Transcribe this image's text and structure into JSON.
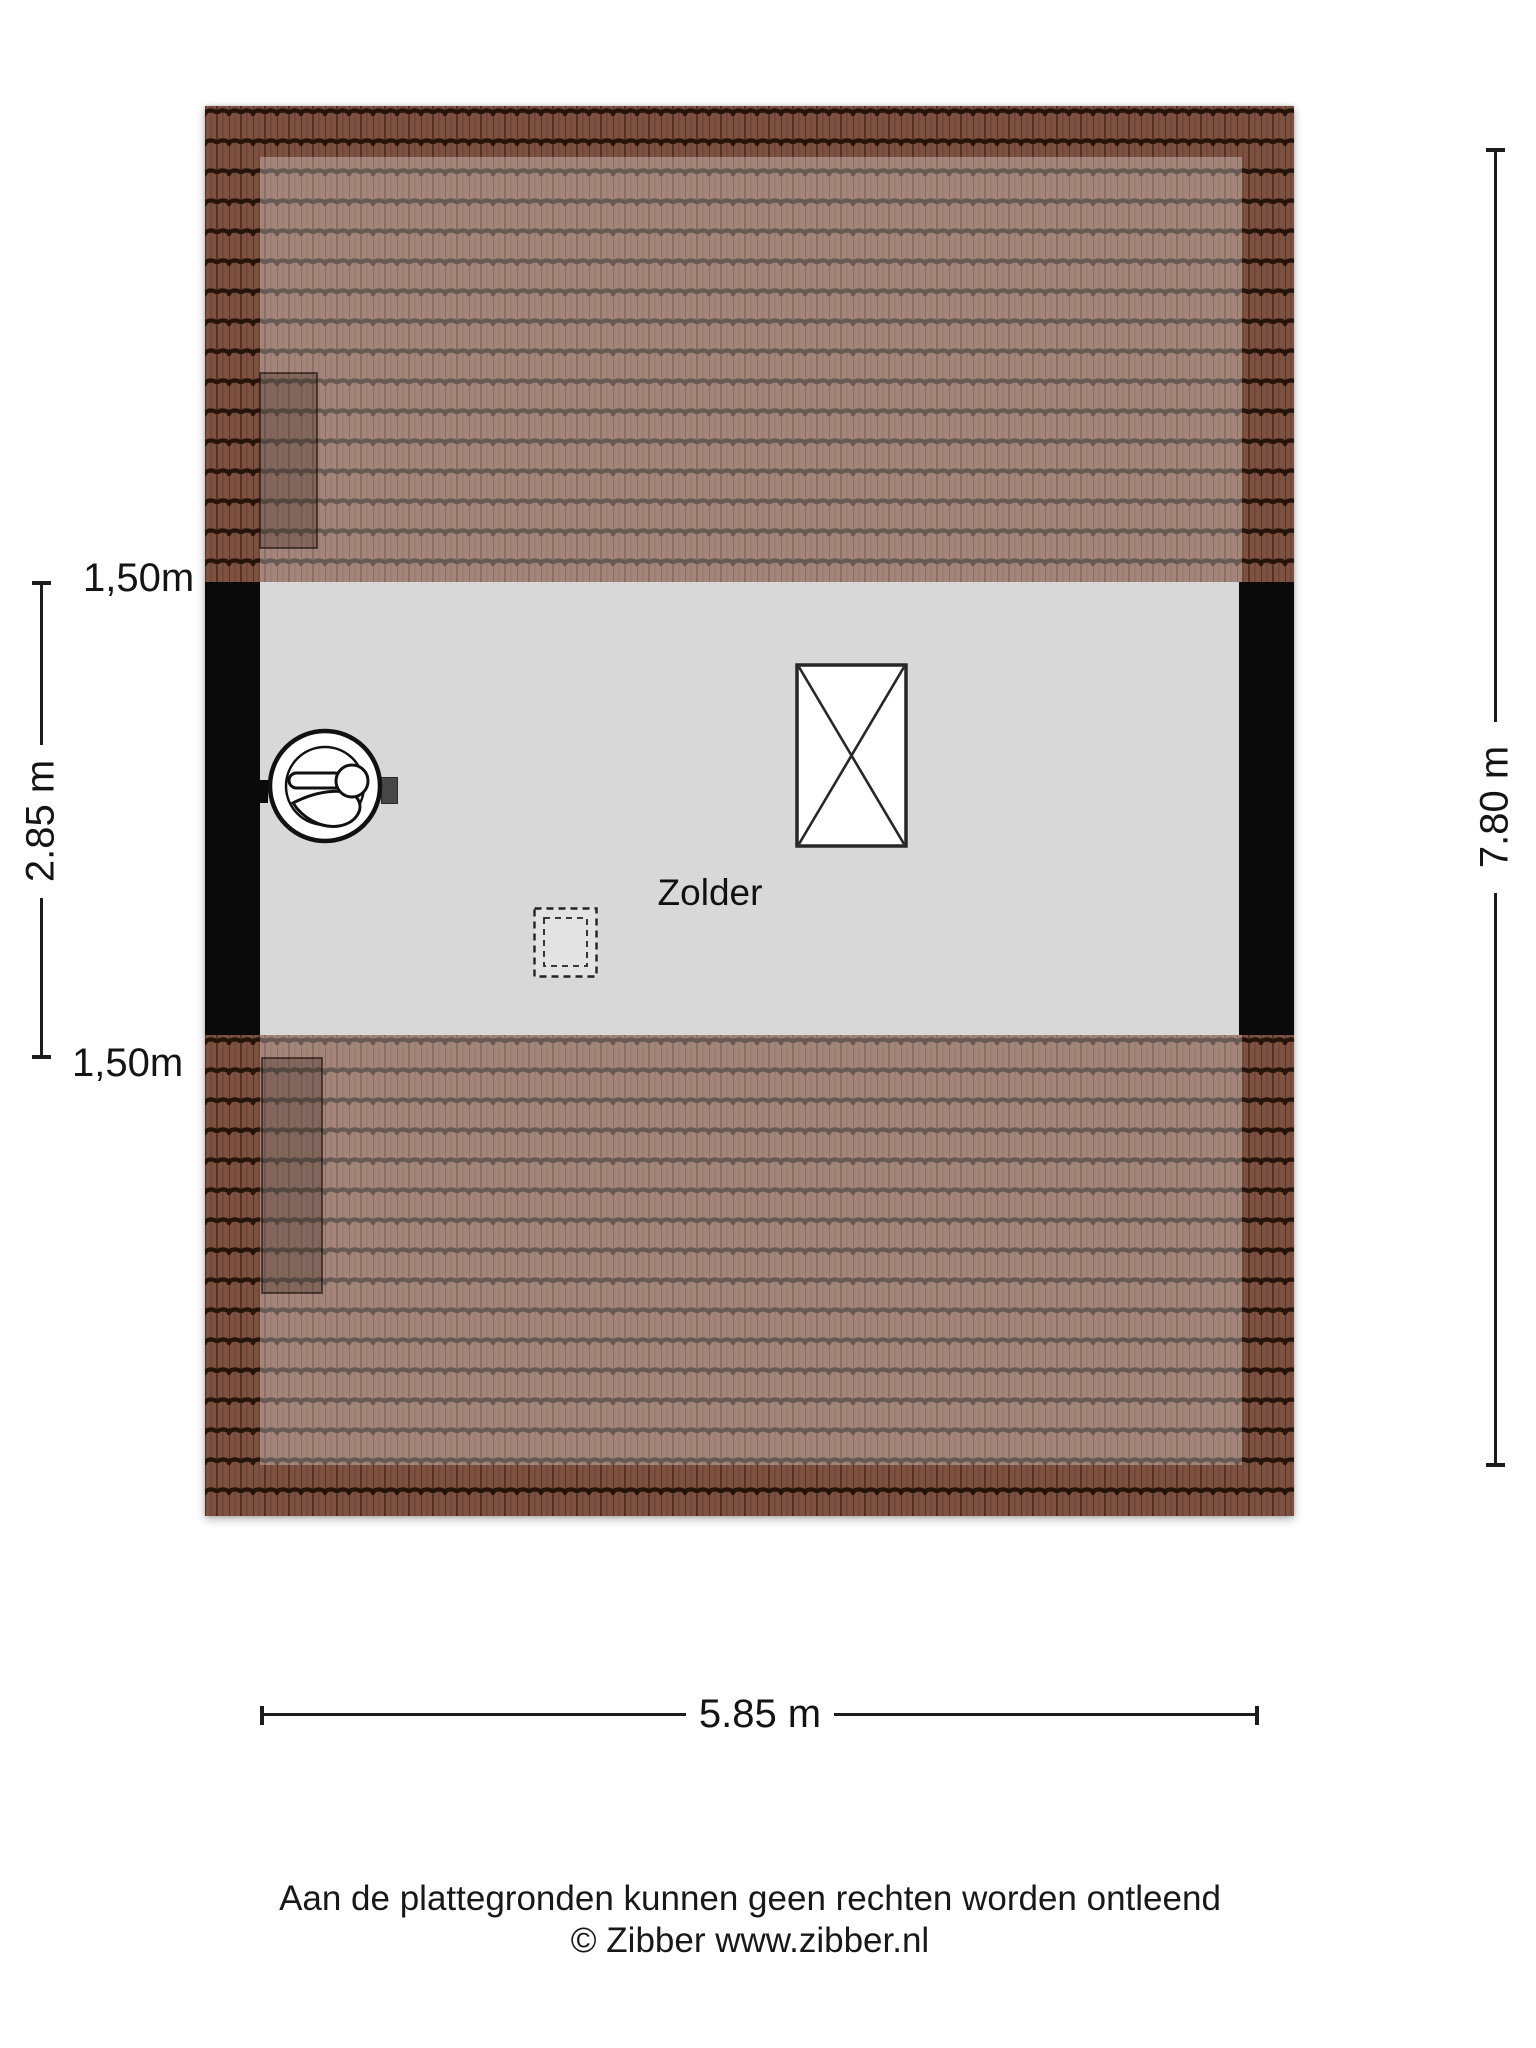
{
  "floorplan": {
    "room_label": "Zolder",
    "dimensions": {
      "left_top_label": "1,50m",
      "left_height_label": "2.85 m",
      "left_bottom_label": "1,50m",
      "right_height_label": "7.80 m",
      "bottom_width_label": "5.85 m"
    },
    "colors": {
      "floor": "#d8d8d8",
      "wall": "#0a0a0a",
      "roof_base": "#7f5140",
      "roof_groove": "#241409",
      "roof_light_overlay": "rgba(255,255,255,0.30)",
      "dimension_line": "#1c1c1c"
    }
  },
  "footer": {
    "disclaimer_line1": "Aan de plattegronden kunnen geen rechten worden ontleend",
    "disclaimer_line2": "© Zibber www.zibber.nl"
  }
}
